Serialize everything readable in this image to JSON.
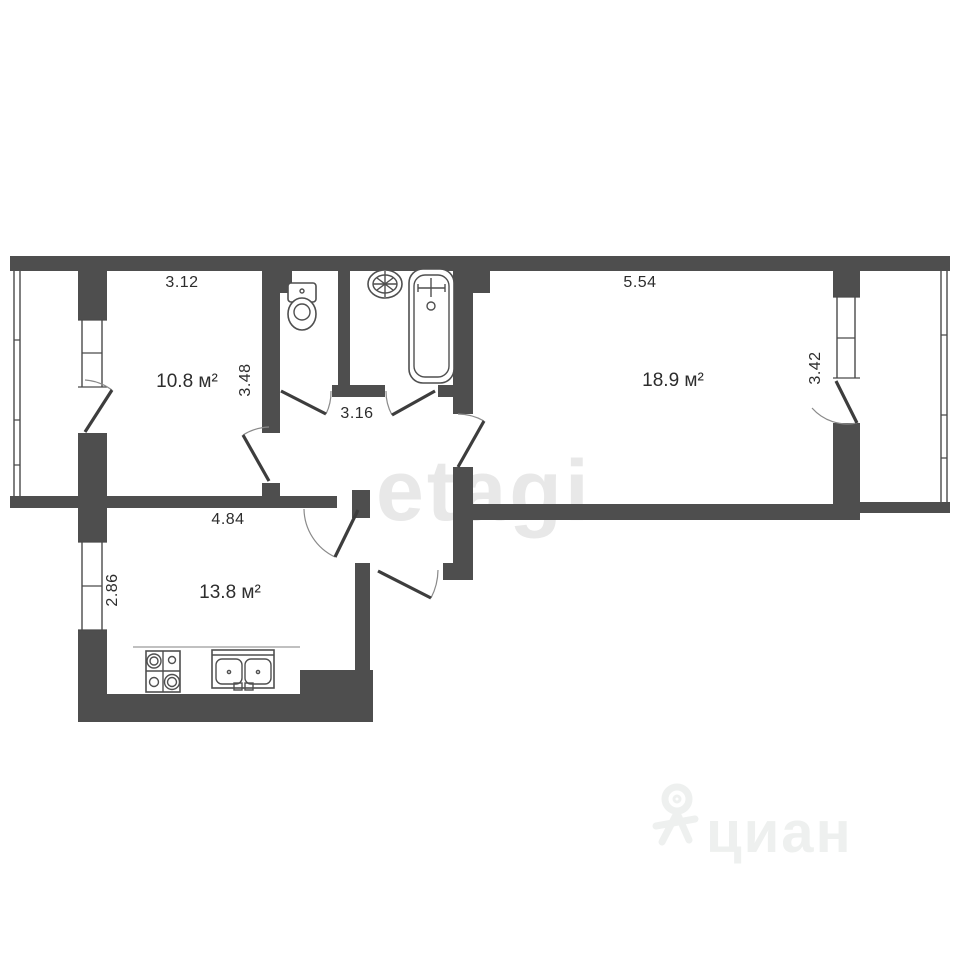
{
  "plan": {
    "labels": {
      "room1_area": "10.8 м²",
      "room1_width": "3.12",
      "room1_depth": "3.48",
      "room2_area": "18.9 м²",
      "room2_width": "5.54",
      "room2_depth": "3.42",
      "kitchen_area": "13.8 м²",
      "kitchen_width": "4.84",
      "kitchen_depth": "2.86",
      "hall_width": "3.16"
    },
    "fixtures": [
      "toilet",
      "washbasin",
      "bathtub",
      "stove",
      "kitchen-sink"
    ],
    "colors": {
      "wall": "#4e4e4e",
      "text": "#2d2d2d",
      "watermark_center": "#e8e8e8",
      "watermark_corner": "#eef0ef",
      "background": "#ffffff"
    }
  },
  "watermarks": {
    "center": "etagi",
    "bottom_right": "циан"
  }
}
